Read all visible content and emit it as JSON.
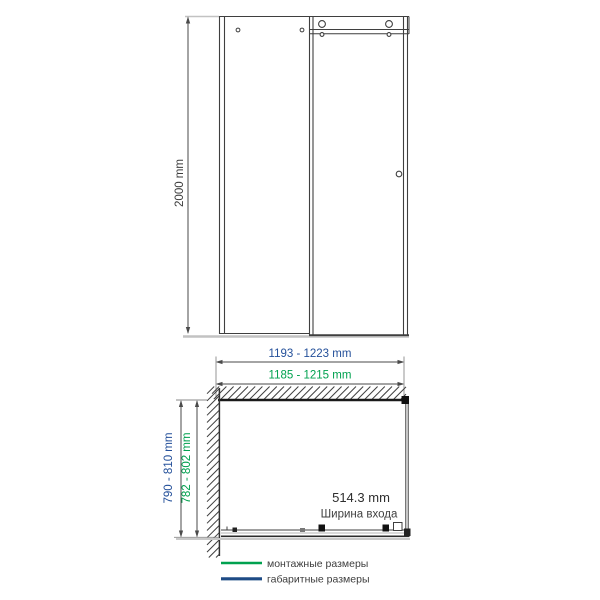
{
  "front_view": {
    "height_dim": "2000 mm"
  },
  "plan_view": {
    "overall_width_dim": "1193 - 1223 mm",
    "mounting_width_dim": "1185 - 1215 mm",
    "overall_depth_dim": "790 - 810 mm",
    "mounting_depth_dim": "782 - 802 mm",
    "entrance_width_value": "514.3 mm",
    "entrance_width_label": "Ширина входа"
  },
  "legend": {
    "mounting": {
      "label": "монтажные размеры",
      "color": "#00A14F"
    },
    "overall": {
      "label": "габаритные размеры",
      "color": "#1E4B85"
    }
  },
  "colors": {
    "drawing_line": "#3F3F3F",
    "dimension_line": "#4A4A4A",
    "overall_dim_text": "#24509A",
    "mounting_dim_text": "#00A14F"
  }
}
